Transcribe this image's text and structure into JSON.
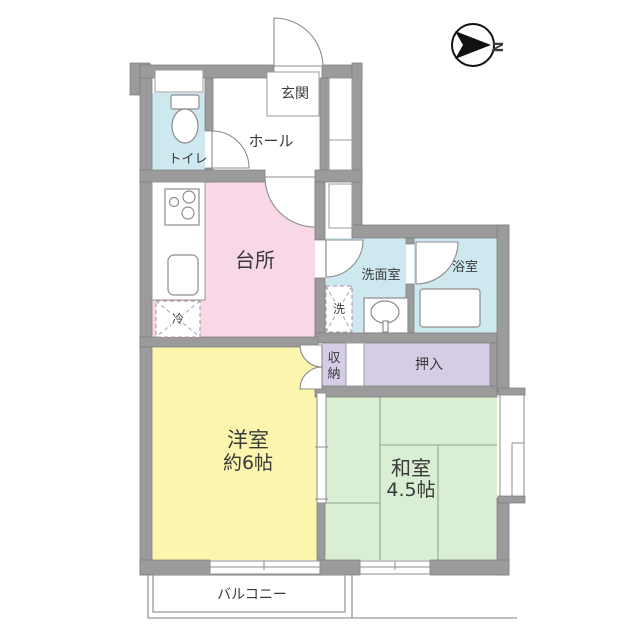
{
  "title": "apartment-floor-plan",
  "palette": {
    "wall": "#9b9b9b",
    "wall_stroke": "#7d7d7d",
    "kitchen": "#f8d7e7",
    "western_room": "#fbf5ae",
    "japanese_room": "#d9eed3",
    "wet_area": "#cde8ef",
    "closet": "#d5cde6",
    "line": "#8c8c8c",
    "text": "#3a3a3a"
  },
  "compass": {
    "label": "N"
  },
  "rooms": {
    "genkan": {
      "label": "玄関"
    },
    "hall": {
      "label": "ホール"
    },
    "toilet": {
      "label": "トイレ"
    },
    "kitchen": {
      "label": "台所"
    },
    "washroom": {
      "label": "洗面室"
    },
    "laundry": {
      "label": "洗"
    },
    "fridge": {
      "label": "冷"
    },
    "bathroom": {
      "label": "浴室"
    },
    "storage": {
      "label": "収納",
      "line1": "収",
      "line2": "納"
    },
    "oshiire": {
      "label": "押入"
    },
    "western": {
      "name": "洋室",
      "size": "約6帖"
    },
    "japanese": {
      "name": "和室",
      "size": "4.5帖"
    },
    "balcony": {
      "label": "バルコニー"
    }
  }
}
